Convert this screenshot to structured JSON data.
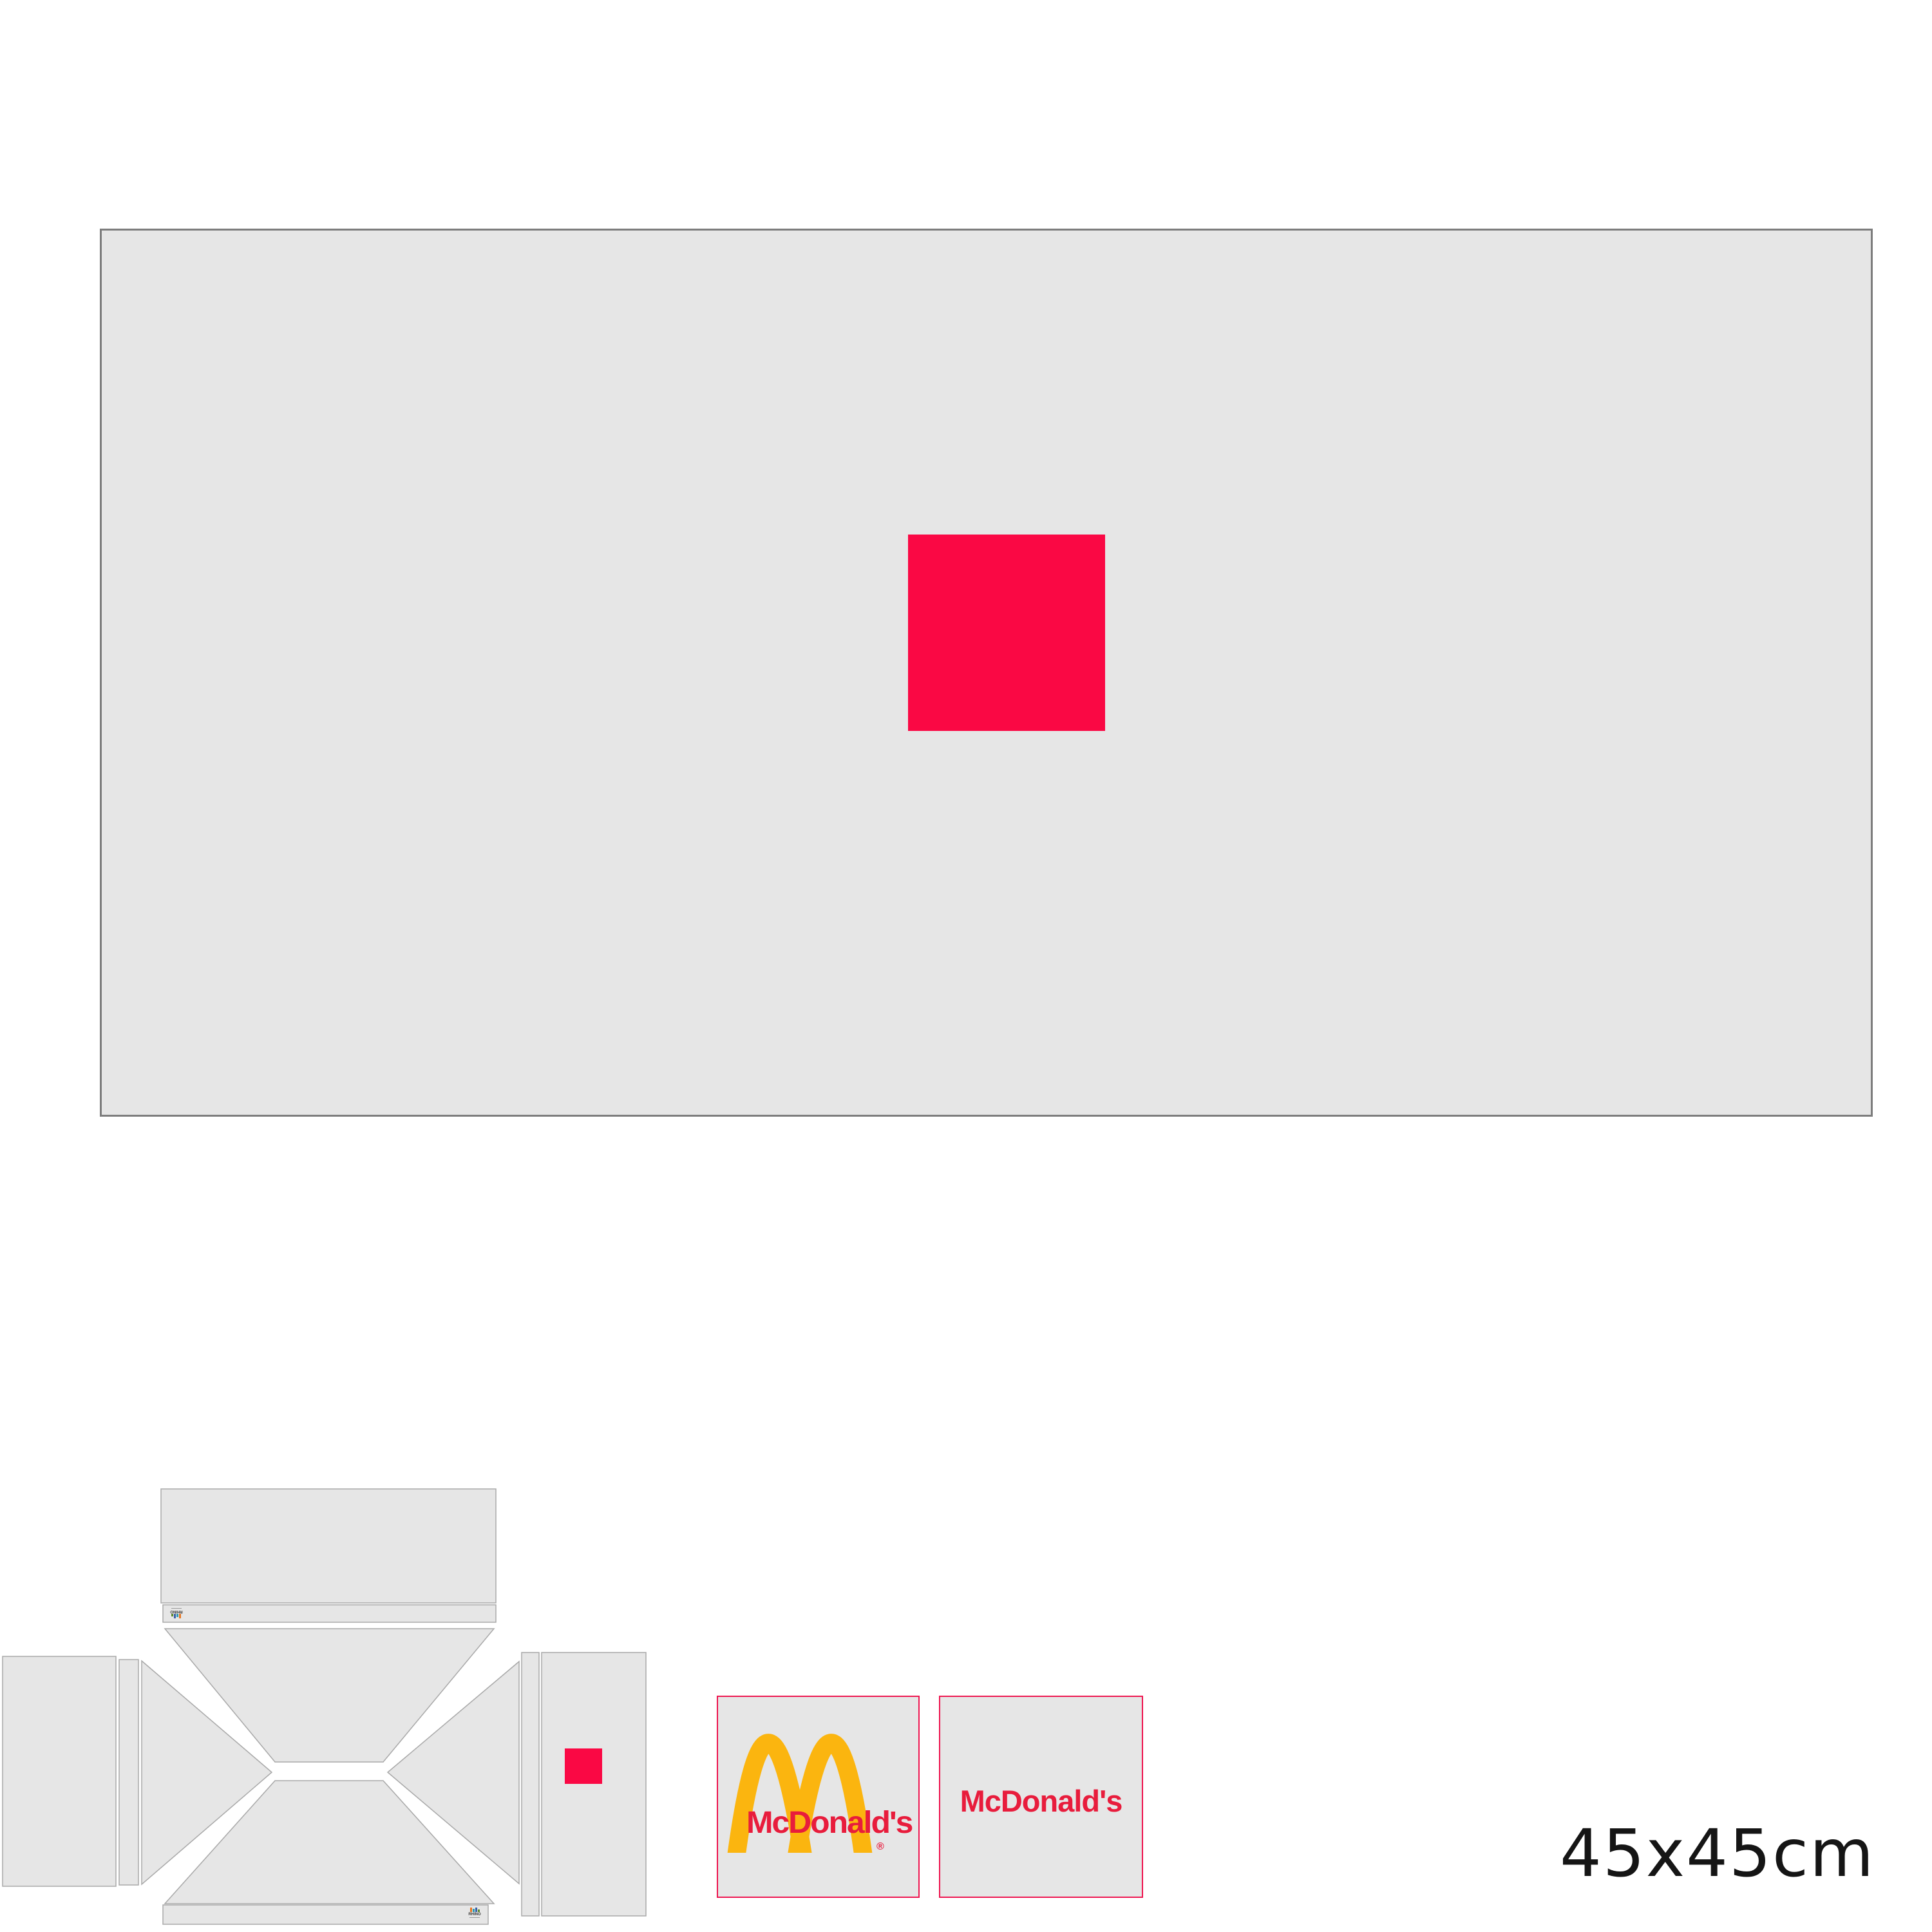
{
  "colors": {
    "panel_gray": "#E6E6E6",
    "sheet_border": "#7D7D7D",
    "die_stroke": "#A8A8A8",
    "accent_red": "#FA0844",
    "mcd_border_red": "#EE1650",
    "mcd_text_red": "#E81C3C",
    "arches_gold": "#FBB50F",
    "label_black": "#151515",
    "mark_orange": "#E87722",
    "mark_teal": "#2B9AB3",
    "mark_blue": "#3A5FA8",
    "mark_green": "#5C8A2E"
  },
  "tiles": {
    "logo_tile": {
      "brand": "McDonald's",
      "registered": "®"
    },
    "wordmark_tile": {
      "brand": "McDonald's"
    }
  },
  "die_marks": {
    "top_mark": "RHINO",
    "bottom_mark": "RHINO"
  },
  "size_label": "45x45cm"
}
